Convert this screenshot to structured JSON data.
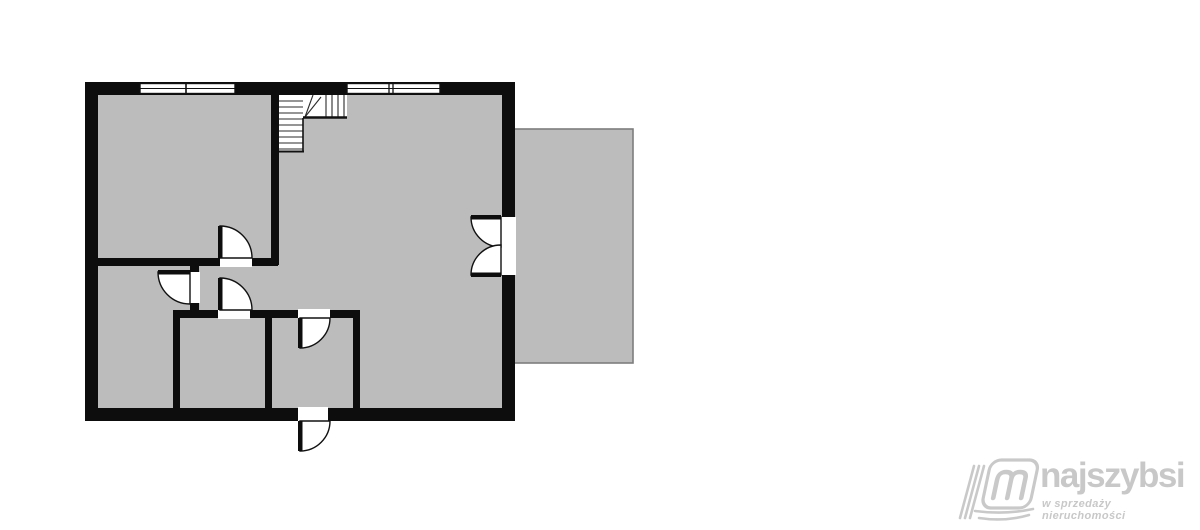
{
  "floor_plan": {
    "type": "floor-plan",
    "wall_color": "#0d0d0d",
    "floor_color": "#bcbcbc",
    "balcony_border_color": "#7d7d7d",
    "features": [
      "staircase-top-center",
      "two-windows-top-wall",
      "double-french-door-to-balcony-right",
      "entry-door-bottom-opening-outward",
      "four-interior-door-swings",
      "balcony-terrace-right"
    ]
  },
  "agent": {
    "name": "Przemysław Kręcki",
    "email": "pk@szczecin-nieruchomosci.eu",
    "photo": "man-in-white-shirt-arms-crossed-gray-background"
  },
  "brand": {
    "name": "najszybsi",
    "tagline": "w sprzedaży nieruchomości",
    "color": "#c8c8c8"
  }
}
